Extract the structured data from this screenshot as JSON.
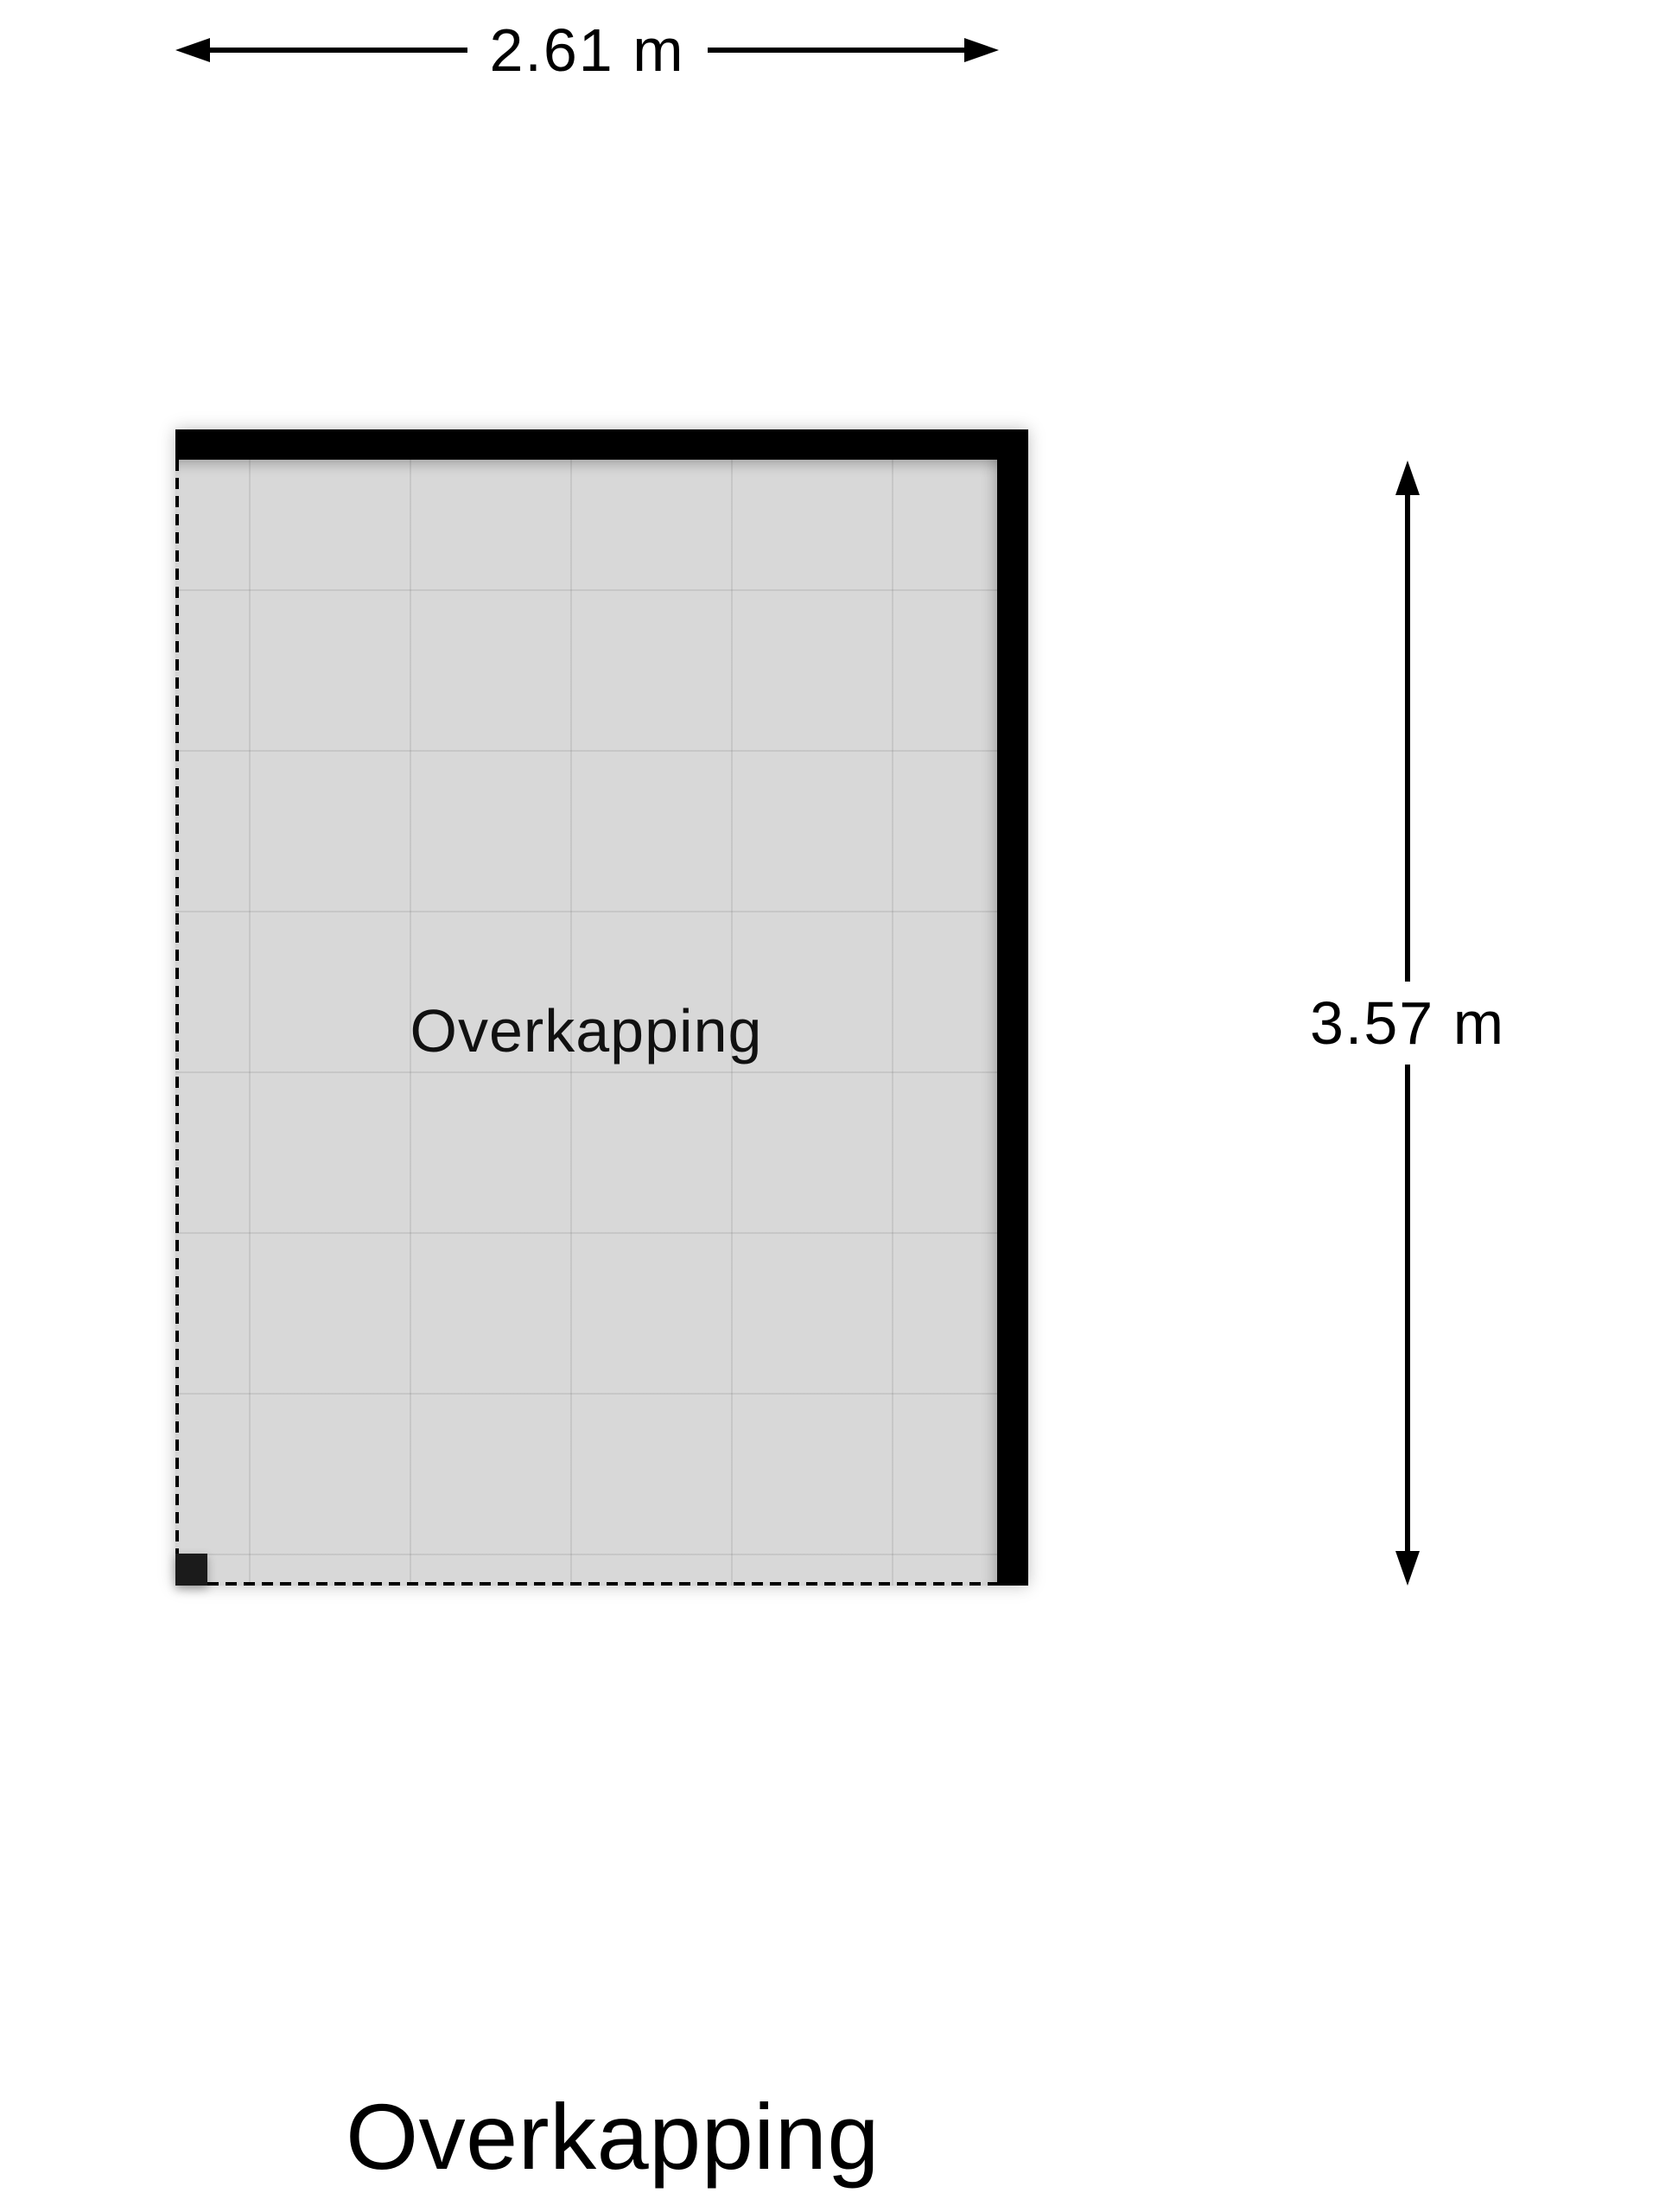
{
  "plan": {
    "room_label": "Overkapping",
    "caption": "Overkapping",
    "width_dimension_label": "2.61 m",
    "height_dimension_label": "3.57 m"
  },
  "colors": {
    "wall": "#000000",
    "floor": "#d8d8d8",
    "grid_line": "#c9c9c9",
    "background": "#ffffff",
    "text": "#000000",
    "corner_post": "#1b1b1b"
  }
}
